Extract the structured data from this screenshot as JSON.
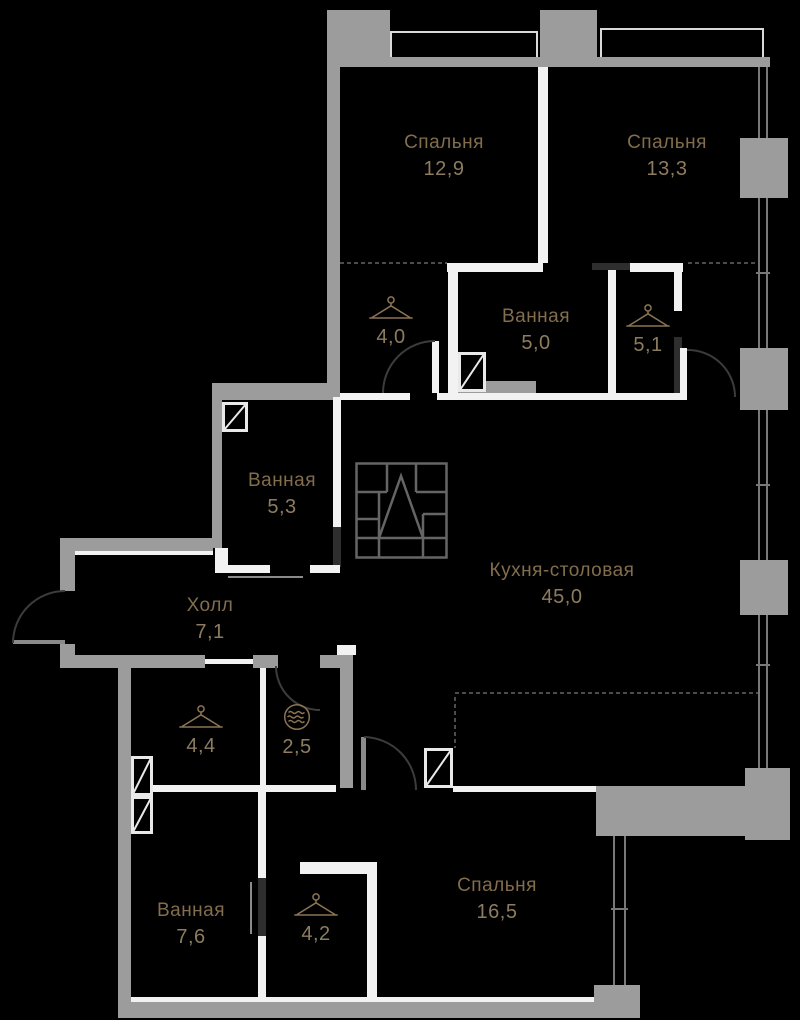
{
  "plan": {
    "title": "Планировка квартиры",
    "colors": {
      "background": "#000000",
      "wall_concrete": "#9c9c9c",
      "wall_interior": "#f2f2f2",
      "label_name": "#826d4c",
      "label_number": "#8d7c5f"
    },
    "icons": {
      "wardrobe": "hanger-icon",
      "laundry": "washing-machine-icon",
      "logo": "geometric-logo"
    }
  },
  "rooms": {
    "bedroom_1": {
      "name": "Спальня",
      "area": "12,9"
    },
    "bedroom_2": {
      "name": "Спальня",
      "area": "13,3"
    },
    "wardrobe_top": {
      "name": "",
      "area": "4,0"
    },
    "bathroom_top": {
      "name": "Ванная",
      "area": "5,0"
    },
    "closet_right": {
      "name": "",
      "area": "5,1"
    },
    "bathroom_mid": {
      "name": "Ванная",
      "area": "5,3"
    },
    "hall": {
      "name": "Холл",
      "area": "7,1"
    },
    "kitchen": {
      "name": "Кухня-столовая",
      "area": "45,0"
    },
    "wardrobe_left": {
      "name": "",
      "area": "4,4"
    },
    "laundry": {
      "name": "",
      "area": "2,5"
    },
    "bathroom_bottom": {
      "name": "Ванная",
      "area": "7,6"
    },
    "wardrobe_bottom": {
      "name": "",
      "area": "4,2"
    },
    "bedroom_3": {
      "name": "Спальня",
      "area": "16,5"
    }
  }
}
